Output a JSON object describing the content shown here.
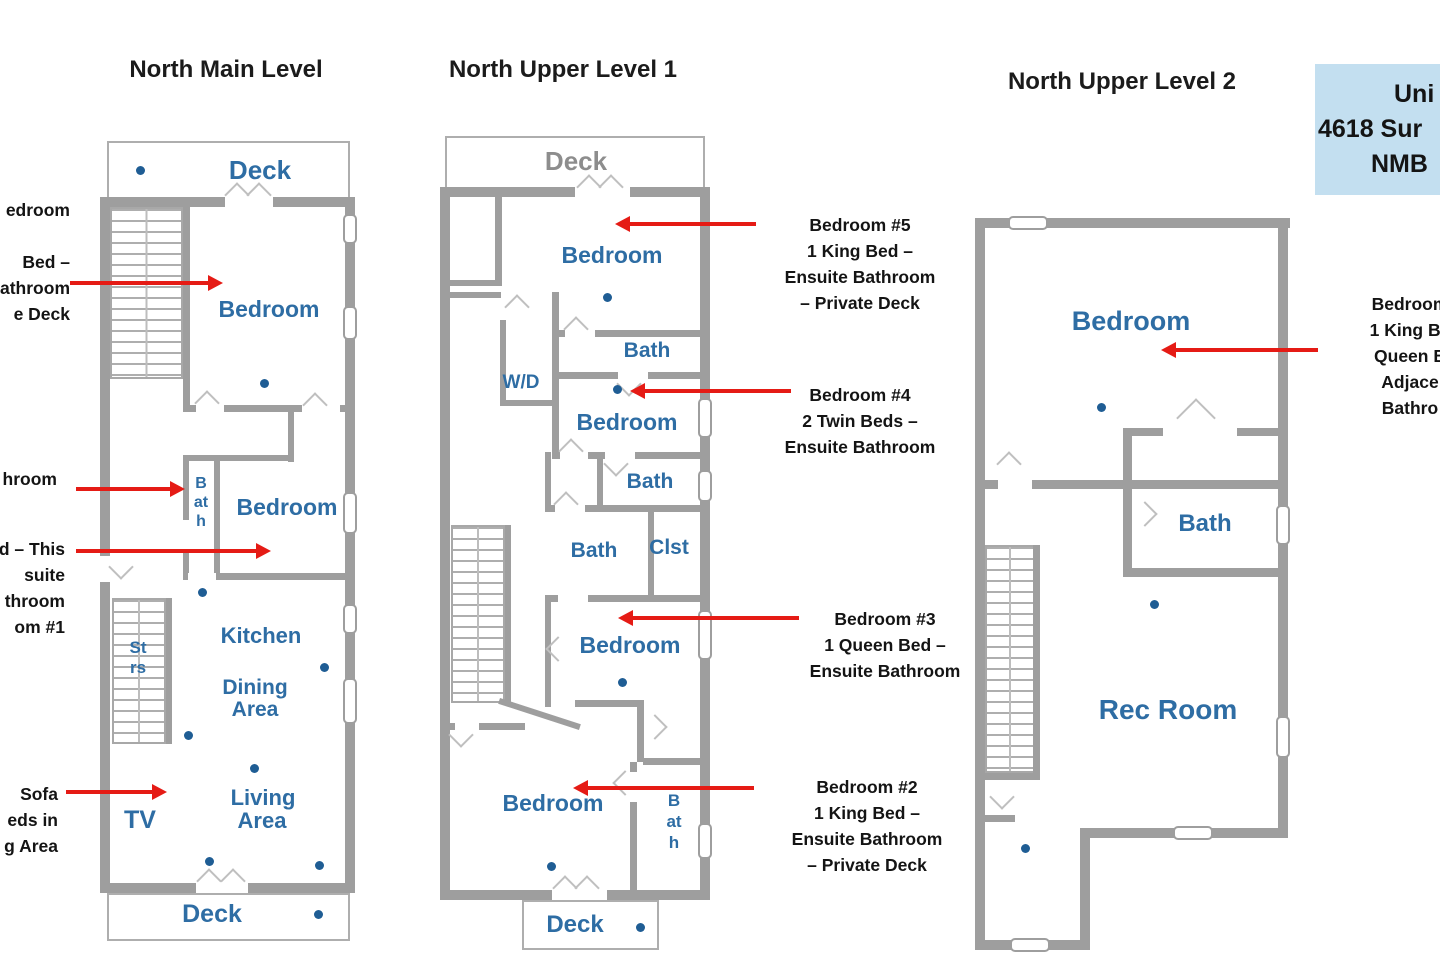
{
  "titles": {
    "main": "North Main Level",
    "upper1": "North Upper Level 1",
    "upper2": "North Upper Level 2"
  },
  "address_box": {
    "l1": "Uni",
    "l2": "4618 Sur",
    "l3": "NMB"
  },
  "plan_main": {
    "deck_top": "Deck",
    "bedroom1": "Bedroom",
    "bath": "Bath",
    "bedroom2": "Bedroom",
    "stairs": "Strs",
    "kitchen": "Kitchen",
    "dining_l1": "Dining",
    "dining_l2": "Area",
    "living_l1": "Living",
    "living_l2": "Area",
    "tv": "TV",
    "deck_bottom": "Deck"
  },
  "plan_upper1": {
    "deck_top": "Deck",
    "bedroom5": "Bedroom",
    "wd": "W/D",
    "bath1": "Bath",
    "bedroom4": "Bedroom",
    "bath2": "Bath",
    "bath3": "Bath",
    "closet": "Clst",
    "bedroom3": "Bedroom",
    "bedroom2": "Bedroom",
    "bath4": "Bath",
    "deck_bottom": "Deck"
  },
  "plan_upper2": {
    "bedroom": "Bedroom",
    "bath": "Bath",
    "rec_room": "Rec Room"
  },
  "callouts": {
    "left_bedroom6": {
      "l1": "edroom",
      "l2": "",
      "l3": "Bed –",
      "l4": "athroom",
      "l5": "e Deck"
    },
    "left_bath": {
      "l1": "hroom"
    },
    "left_bedroom1": {
      "l1": "d – This",
      "l2": "suite",
      "l3": "throom",
      "l4": "om #1"
    },
    "left_sofa": {
      "l1": "Sofa",
      "l2": "eds in",
      "l3": "g Area"
    },
    "bedroom5": {
      "l1": "Bedroom #5",
      "l2": "1 King Bed –",
      "l3": "Ensuite Bathroom",
      "l4": "– Private Deck"
    },
    "bedroom4": {
      "l1": "Bedroom #4",
      "l2": "2 Twin Beds –",
      "l3": "Ensuite Bathroom"
    },
    "bedroom3": {
      "l1": "Bedroom #3",
      "l2": "1 Queen Bed –",
      "l3": "Ensuite Bathroom"
    },
    "bedroom2": {
      "l1": "Bedroom #2",
      "l2": "1 King Bed –",
      "l3": "Ensuite Bathroom",
      "l4": "– Private Deck"
    },
    "right_bedroom": {
      "l1": "Bedroom",
      "l2": "1 King Be",
      "l3": "Queen B",
      "l4": "Adjace",
      "l5": "Bathro"
    }
  },
  "colors": {
    "wall": "#9e9e9e",
    "room_label": "#2e6da4",
    "dot": "#1f5d94",
    "arrow": "#e51b15",
    "deck_label_gray": "#8d8d8d",
    "address_bg": "#c3dff0"
  }
}
